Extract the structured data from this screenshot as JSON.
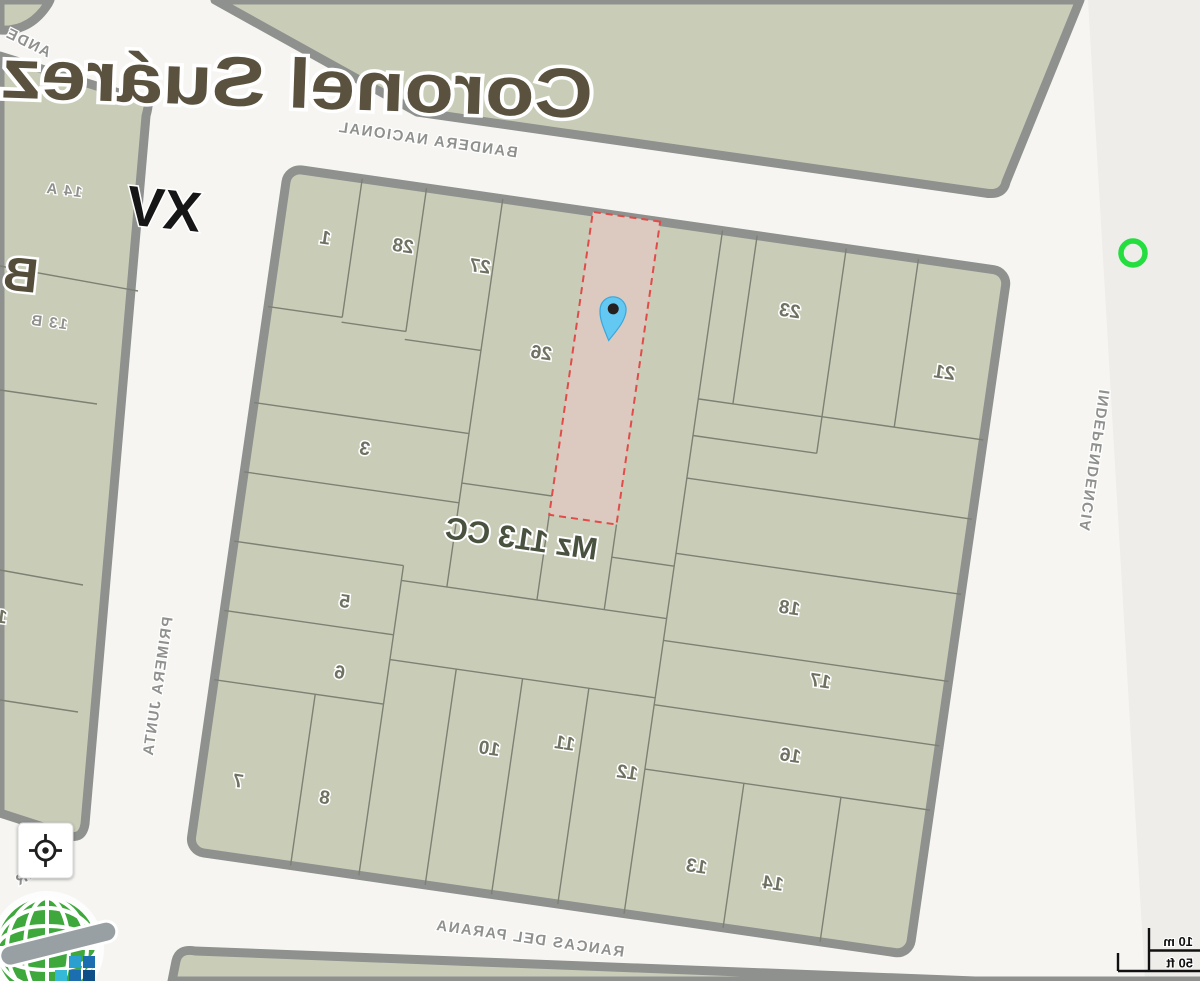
{
  "map": {
    "city_label": "Coronel Suárez",
    "block_label": "Mz 113 CC",
    "zone_label": "XV",
    "section_label": "B",
    "adjacent_parcels": {
      "p14a": "14 A",
      "p13b": "13 B",
      "partial": "1"
    },
    "streets": {
      "bandera_nacional": "BANDERA NACIONAL",
      "independencia": "INDEPENDENCIA",
      "primera_junta": "PRIMERA JUNTA",
      "barrancas_del_parana": "RANCAS DEL PARANA",
      "barrancas_prefix": "BAR",
      "andes_partial": "ANDE"
    },
    "parcels": [
      {
        "number": "1"
      },
      {
        "number": "28"
      },
      {
        "number": "27"
      },
      {
        "number": "26"
      },
      {
        "number": "23"
      },
      {
        "number": "21"
      },
      {
        "number": "3"
      },
      {
        "number": "5"
      },
      {
        "number": "6"
      },
      {
        "number": "7"
      },
      {
        "number": "8"
      },
      {
        "number": "10"
      },
      {
        "number": "11"
      },
      {
        "number": "12"
      },
      {
        "number": "13"
      },
      {
        "number": "14"
      },
      {
        "number": "16"
      },
      {
        "number": "17"
      },
      {
        "number": "18"
      }
    ]
  },
  "controls": {
    "scale_metric": "10 m",
    "scale_imperial": "50 ft"
  },
  "colors": {
    "block_fill": "#c9cdb8",
    "block_casing": "#8e918e",
    "parcel_line": "#7d8174",
    "highlight_fill": "#dcc9bf",
    "highlight_border": "#e04c49",
    "pin_fill": "#63c9f2",
    "ring_marker": "#24dd3e",
    "city_label": "#5a523e",
    "street_label": "#8f918e",
    "background": "#f6f5f2"
  }
}
